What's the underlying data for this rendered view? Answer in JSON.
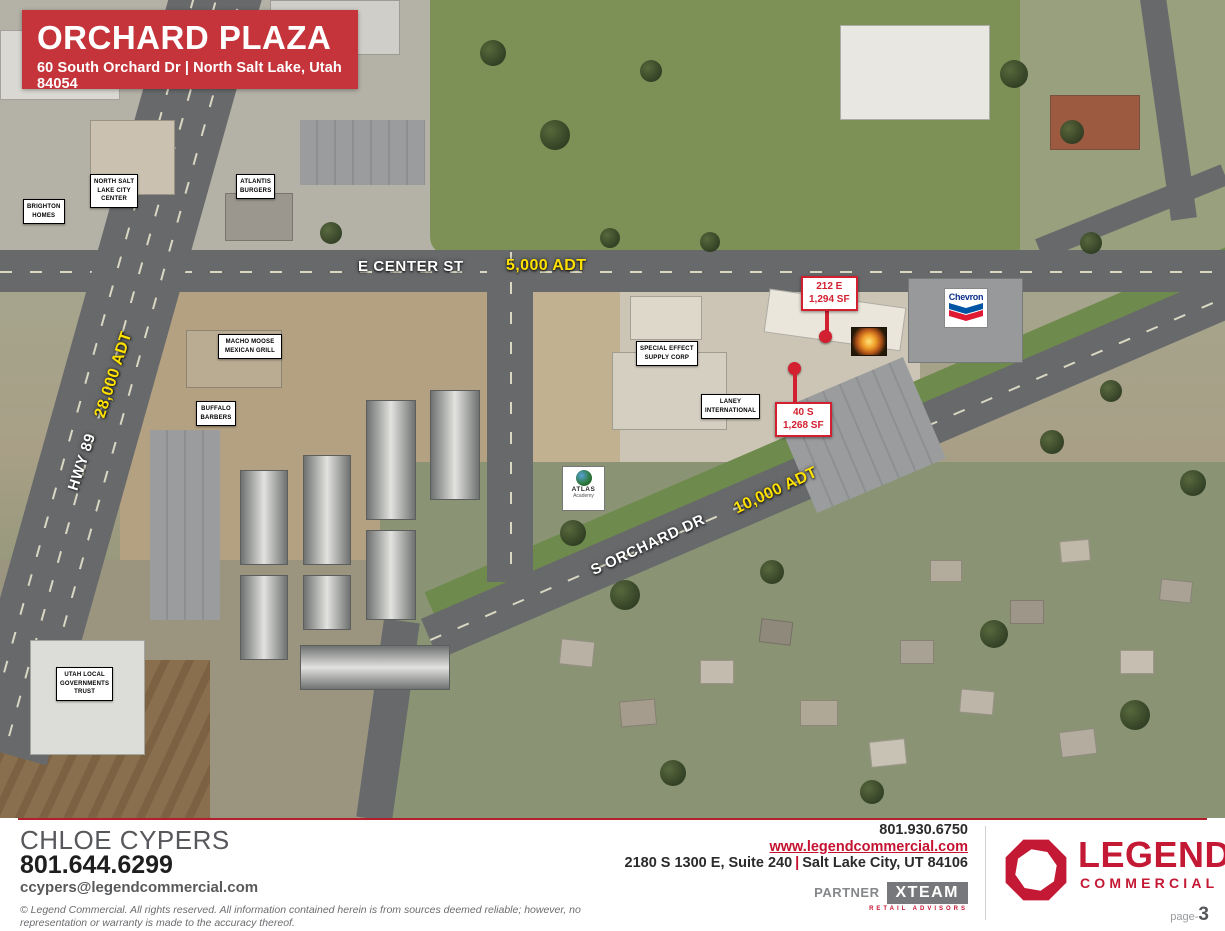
{
  "header": {
    "title": "ORCHARD PLAZA",
    "subtitle": "60 South Orchard Dr  |  North Salt Lake, Utah 84054"
  },
  "map": {
    "streets": {
      "e_center": "E CENTER ST",
      "hwy_89": "HWY 89",
      "s_orchard": "S ORCHARD DR"
    },
    "traffic": {
      "e_center_adt": "5,000 ADT",
      "hwy_89_adt": "28,000 ADT",
      "s_orchard_adt": "10,000 ADT"
    },
    "businesses": [
      {
        "name": "BRIGHTON\nHOMES"
      },
      {
        "name": "NORTH SALT\nLAKE CITY\nCENTER"
      },
      {
        "name": "ATLANTIS\nBURGERS"
      },
      {
        "name": "MACHO MOOSE\nMEXICAN GRILL"
      },
      {
        "name": "BUFFALO\nBARBERS"
      },
      {
        "name": "SPECIAL EFFECT\nSUPPLY CORP"
      },
      {
        "name": "LANEY\nINTERNATIONAL"
      },
      {
        "name": "UTAH LOCAL\nGOVERNMENTS\nTRUST"
      }
    ],
    "callouts": [
      {
        "address": "212 E",
        "size": "1,294 SF"
      },
      {
        "address": "40 S",
        "size": "1,268 SF"
      }
    ],
    "signs": {
      "chevron": "Chevron",
      "atlas_line1": "ATLAS",
      "atlas_line2": "Academy"
    }
  },
  "footer": {
    "agent": {
      "name": "CHLOE CYPERS",
      "phone": "801.644.6299",
      "email": "ccypers@legendcommercial.com"
    },
    "company": {
      "phone": "801.930.6750",
      "website": "www.legendcommercial.com",
      "address_left": "2180 S 1300 E, Suite 240",
      "address_separator": "|",
      "address_right": "Salt Lake City, UT 84106",
      "partner_label": "PARTNER",
      "partner_logo": "XTEAM",
      "partner_sub": "RETAIL ADVISORS"
    },
    "logo": {
      "line1": "LEGEND",
      "line2": "COMMERCIAL"
    },
    "disclaimer": "© Legend Commercial. All rights reserved. All information contained herein is from sources deemed reliable;  however, no representation or warranty is made to the accuracy thereof.",
    "page": {
      "label": "page-",
      "number": "3"
    }
  },
  "colors": {
    "brand_red": "#c5343a",
    "callout_red": "#d22030",
    "traffic_yellow": "#ffe100"
  }
}
